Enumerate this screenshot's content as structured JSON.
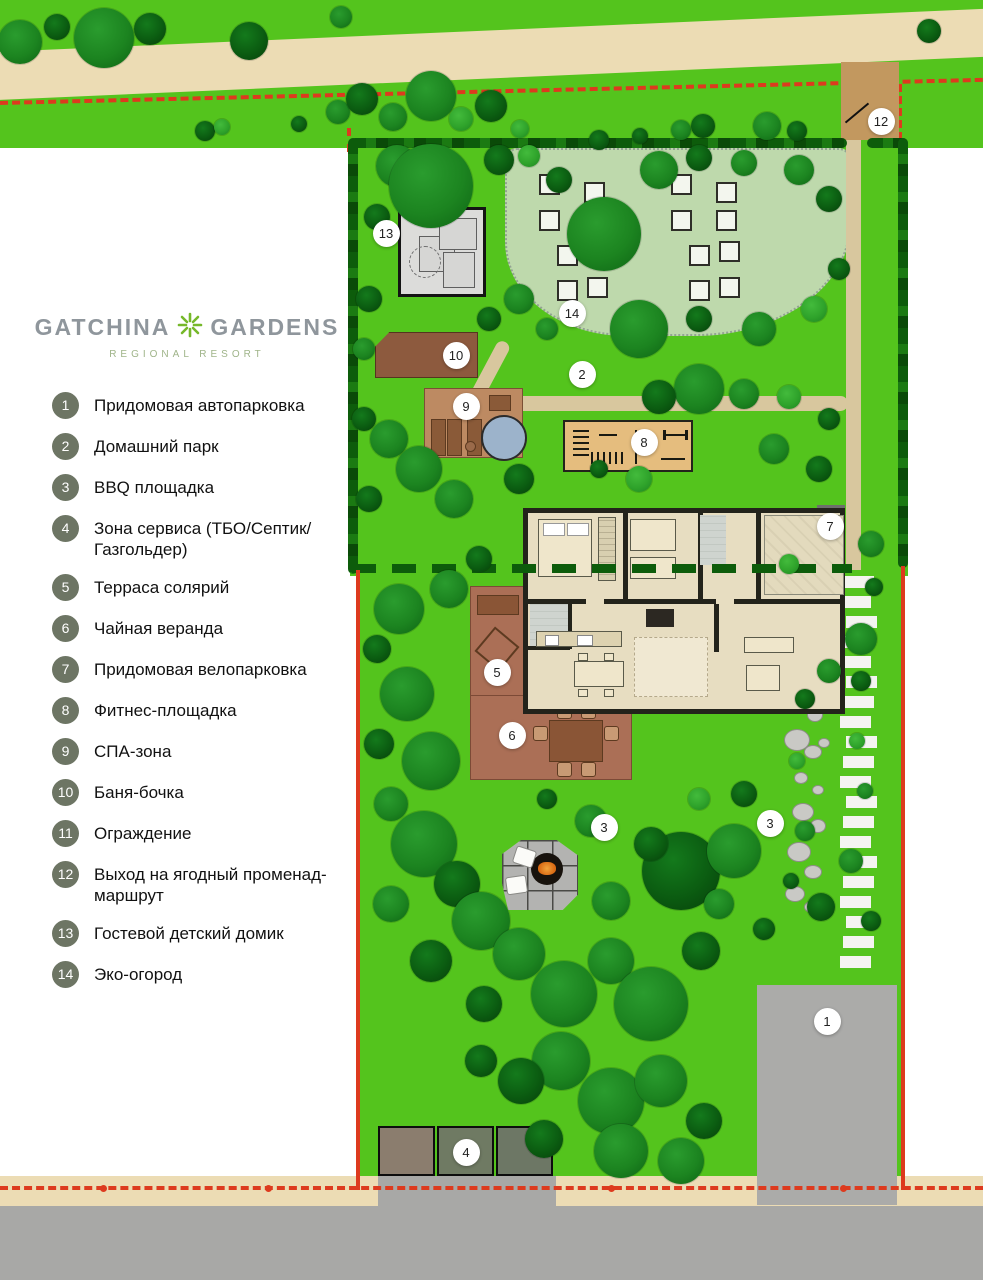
{
  "logo": {
    "brand_left": "GATCHINA",
    "brand_right": "GARDENS",
    "subtitle": "REGIONAL RESORT"
  },
  "legend": {
    "items": [
      {
        "n": "1",
        "label": "Придомовая автопарковка"
      },
      {
        "n": "2",
        "label": "Домашний парк"
      },
      {
        "n": "3",
        "label": "BBQ площадка"
      },
      {
        "n": "4",
        "label": "Зона сервиса (ТБО/Септик/ Газгольдер)"
      },
      {
        "n": "5",
        "label": "Терраса солярий"
      },
      {
        "n": "6",
        "label": "Чайная веранда"
      },
      {
        "n": "7",
        "label": "Придомовая велопарковка"
      },
      {
        "n": "8",
        "label": "Фитнес-площадка"
      },
      {
        "n": "9",
        "label": "СПА-зона"
      },
      {
        "n": "10",
        "label": "Баня-бочка"
      },
      {
        "n": "11",
        "label": "Ограждение"
      },
      {
        "n": "12",
        "label": "Выход на ягодный променад-маршрут"
      },
      {
        "n": "13",
        "label": "Гостевой детский домик"
      },
      {
        "n": "14",
        "label": "Эко-огород"
      }
    ]
  },
  "map": {
    "markers": [
      {
        "n": "1",
        "x": 827,
        "y": 1021
      },
      {
        "n": "2",
        "x": 582,
        "y": 374
      },
      {
        "n": "3",
        "x": 604,
        "y": 827
      },
      {
        "n": "3",
        "x": 770,
        "y": 823
      },
      {
        "n": "4",
        "x": 466,
        "y": 1152
      },
      {
        "n": "5",
        "x": 497,
        "y": 672
      },
      {
        "n": "6",
        "x": 512,
        "y": 735
      },
      {
        "n": "7",
        "x": 830,
        "y": 526
      },
      {
        "n": "8",
        "x": 644,
        "y": 442
      },
      {
        "n": "9",
        "x": 466,
        "y": 406
      },
      {
        "n": "10",
        "x": 456,
        "y": 355
      },
      {
        "n": "12",
        "x": 881,
        "y": 121
      },
      {
        "n": "13",
        "x": 386,
        "y": 233
      },
      {
        "n": "14",
        "x": 572,
        "y": 313
      }
    ],
    "bed_clusters": [
      {
        "x": 538,
        "y": 172
      },
      {
        "x": 670,
        "y": 172
      }
    ],
    "bed_offsets": [
      [
        1,
        2
      ],
      [
        46,
        10
      ],
      [
        1,
        38
      ],
      [
        46,
        38
      ],
      [
        19,
        73
      ],
      [
        49,
        69
      ],
      [
        19,
        108
      ],
      [
        49,
        105
      ]
    ],
    "stepping_path": {
      "x": 843,
      "y": 576,
      "w": 31,
      "count": 20,
      "slab_h": 12,
      "gap": 8
    },
    "trees": [
      [
        20,
        42,
        22,
        0
      ],
      [
        57,
        27,
        13,
        1
      ],
      [
        104,
        38,
        30,
        0
      ],
      [
        150,
        29,
        16,
        1
      ],
      [
        249,
        41,
        19,
        1
      ],
      [
        341,
        17,
        11,
        0
      ],
      [
        205,
        131,
        10,
        1
      ],
      [
        222,
        127,
        8,
        2
      ],
      [
        299,
        124,
        8,
        1
      ],
      [
        338,
        112,
        12,
        0
      ],
      [
        362,
        99,
        16,
        1
      ],
      [
        393,
        117,
        14,
        0
      ],
      [
        431,
        96,
        25,
        0
      ],
      [
        461,
        119,
        12,
        2
      ],
      [
        491,
        106,
        16,
        1
      ],
      [
        520,
        129,
        9,
        2
      ],
      [
        599,
        140,
        10,
        1
      ],
      [
        640,
        136,
        8,
        1
      ],
      [
        681,
        130,
        10,
        0
      ],
      [
        703,
        126,
        12,
        1
      ],
      [
        767,
        126,
        14,
        0
      ],
      [
        797,
        131,
        10,
        1
      ],
      [
        929,
        31,
        12,
        1
      ],
      [
        397,
        166,
        21,
        0
      ],
      [
        431,
        186,
        42,
        0
      ],
      [
        377,
        217,
        13,
        1
      ],
      [
        499,
        160,
        15,
        1
      ],
      [
        529,
        156,
        11,
        2
      ],
      [
        559,
        180,
        13,
        1
      ],
      [
        604,
        234,
        37,
        0
      ],
      [
        659,
        170,
        19,
        0
      ],
      [
        699,
        158,
        13,
        1
      ],
      [
        744,
        163,
        13,
        0
      ],
      [
        799,
        170,
        15,
        0
      ],
      [
        829,
        199,
        13,
        1
      ],
      [
        519,
        299,
        15,
        0
      ],
      [
        489,
        319,
        12,
        1
      ],
      [
        547,
        329,
        11,
        0
      ],
      [
        639,
        329,
        29,
        0
      ],
      [
        699,
        319,
        13,
        1
      ],
      [
        759,
        329,
        17,
        0
      ],
      [
        814,
        309,
        13,
        2
      ],
      [
        839,
        269,
        11,
        1
      ],
      [
        369,
        299,
        13,
        1
      ],
      [
        364,
        349,
        11,
        0
      ],
      [
        389,
        439,
        19,
        0
      ],
      [
        364,
        419,
        12,
        1
      ],
      [
        419,
        469,
        23,
        0
      ],
      [
        369,
        499,
        13,
        1
      ],
      [
        454,
        499,
        19,
        0
      ],
      [
        519,
        479,
        15,
        1
      ],
      [
        699,
        389,
        25,
        0
      ],
      [
        659,
        397,
        17,
        1
      ],
      [
        744,
        394,
        15,
        0
      ],
      [
        789,
        397,
        12,
        2
      ],
      [
        829,
        419,
        11,
        1
      ],
      [
        774,
        449,
        15,
        0
      ],
      [
        819,
        469,
        13,
        1
      ],
      [
        639,
        479,
        13,
        2
      ],
      [
        599,
        469,
        9,
        1
      ],
      [
        479,
        559,
        13,
        1
      ],
      [
        449,
        589,
        19,
        0
      ],
      [
        399,
        609,
        25,
        0
      ],
      [
        377,
        649,
        14,
        1
      ],
      [
        407,
        694,
        27,
        0
      ],
      [
        379,
        744,
        15,
        1
      ],
      [
        431,
        761,
        29,
        0
      ],
      [
        391,
        804,
        17,
        0
      ],
      [
        424,
        844,
        33,
        0
      ],
      [
        457,
        884,
        23,
        1
      ],
      [
        391,
        904,
        18,
        0
      ],
      [
        481,
        921,
        29,
        0
      ],
      [
        431,
        961,
        21,
        1
      ],
      [
        519,
        954,
        26,
        0
      ],
      [
        564,
        994,
        33,
        0
      ],
      [
        484,
        1004,
        18,
        1
      ],
      [
        611,
        961,
        23,
        0
      ],
      [
        651,
        1004,
        37,
        0
      ],
      [
        701,
        951,
        19,
        1
      ],
      [
        561,
        1061,
        29,
        0
      ],
      [
        611,
        1101,
        33,
        0
      ],
      [
        521,
        1081,
        23,
        1
      ],
      [
        661,
        1081,
        26,
        0
      ],
      [
        704,
        1121,
        18,
        1
      ],
      [
        621,
        1151,
        27,
        0
      ],
      [
        681,
        1161,
        23,
        0
      ],
      [
        481,
        1061,
        16,
        1
      ],
      [
        544,
        1139,
        19,
        1
      ],
      [
        591,
        821,
        16,
        0
      ],
      [
        547,
        799,
        10,
        1
      ],
      [
        611,
        901,
        19,
        0
      ],
      [
        681,
        871,
        39,
        1
      ],
      [
        734,
        851,
        27,
        0
      ],
      [
        651,
        844,
        17,
        1
      ],
      [
        699,
        799,
        11,
        2
      ],
      [
        744,
        794,
        13,
        1
      ],
      [
        719,
        904,
        15,
        0
      ],
      [
        764,
        929,
        11,
        1
      ],
      [
        805,
        699,
        10,
        1
      ],
      [
        797,
        761,
        8,
        2
      ],
      [
        805,
        831,
        10,
        0
      ],
      [
        791,
        881,
        8,
        1
      ],
      [
        829,
        671,
        12,
        0
      ],
      [
        821,
        907,
        14,
        1
      ],
      [
        861,
        681,
        10,
        1
      ],
      [
        865,
        791,
        8,
        0
      ],
      [
        851,
        861,
        12,
        0
      ],
      [
        871,
        921,
        10,
        1
      ],
      [
        857,
        741,
        8,
        2
      ],
      [
        874,
        587,
        9,
        1
      ],
      [
        861,
        639,
        16,
        0
      ],
      [
        789,
        564,
        10,
        2
      ],
      [
        871,
        544,
        13,
        0
      ]
    ],
    "stones": [
      [
        800,
        700,
        10,
        8
      ],
      [
        814,
        714,
        7,
        6
      ],
      [
        796,
        739,
        12,
        10
      ],
      [
        812,
        751,
        8,
        6
      ],
      [
        800,
        777,
        6,
        5
      ],
      [
        817,
        789,
        5,
        4
      ],
      [
        802,
        811,
        10,
        8
      ],
      [
        817,
        825,
        7,
        6
      ],
      [
        798,
        851,
        11,
        9
      ],
      [
        812,
        871,
        8,
        6
      ],
      [
        794,
        893,
        9,
        7
      ],
      [
        811,
        906,
        7,
        5
      ],
      [
        800,
        672,
        7,
        5
      ],
      [
        818,
        688,
        5,
        4
      ],
      [
        823,
        742,
        5,
        4
      ]
    ]
  },
  "colors": {
    "lawn_green": "#54c41d",
    "hedge_green": "#0d5c0b",
    "eco_garden_green": "#bed9ac",
    "road_beige": "#ecdcb4",
    "asphalt_gray": "#a8a8a6",
    "path_tan": "#d8c79e",
    "entry_brown": "#c2985f",
    "deck_brown": "#ab6f56",
    "sauna_brown": "#8d5a3e",
    "spa_tan": "#bd8a62",
    "water_blue": "#9cb3cb",
    "fitness_tan": "#e5bd7e",
    "boundary_red": "#dd3a1e",
    "legend_circle_olive": "#6d7564",
    "marker_white": "#ffffff"
  }
}
